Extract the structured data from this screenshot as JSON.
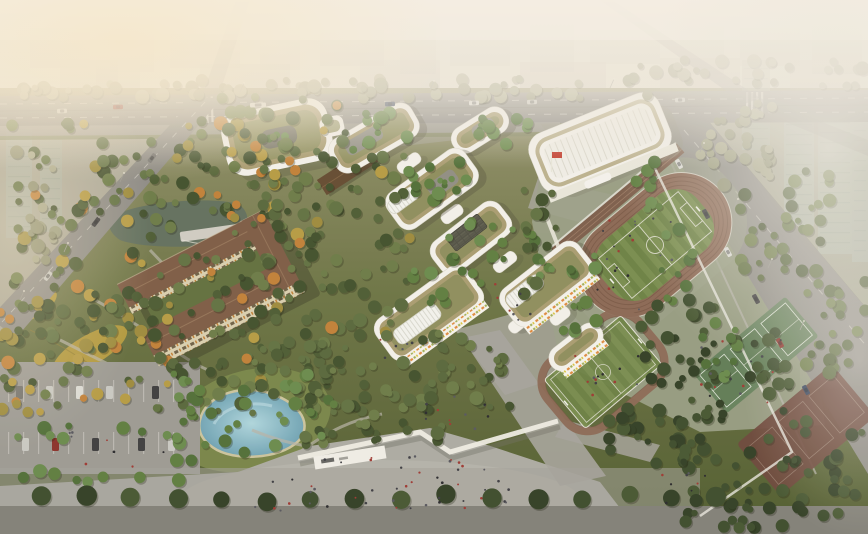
{
  "meta": {
    "type": "architectural-aerial-rendering",
    "title": "School campus aerial rendering",
    "description": "Bird's-eye architectural visualization of a school campus: white curvilinear buildings with green roofs and skylights, a gymnasium, a running track with soccer field, a training field, tennis and basketball courts, dense woodland with ponds and terraced gardens, an entrance plaza with pedestrians, a parking lot, and a hazy city skyline with roads and vehicles."
  },
  "palette": {
    "sky_top": "#d8d2c5",
    "sky_bottom": "#ece5d7",
    "fog": "#f5efe3",
    "warm_glow": "#f7e8ca",
    "city_block": "#bdb8ac",
    "city_glass": "#aeb8ab",
    "urban_ground": "#b6b2a4",
    "road": "#8d8b85",
    "road_line": "#d9d6cd",
    "campus_top": "#95926d",
    "campus_mid": "#6b7343",
    "campus_deep": "#4e5a2c",
    "apron": "#9aa087",
    "plaza": "#abaaa2",
    "pavement": "#807f77",
    "track": "#8a6753",
    "track_lane": "#70503e",
    "grandstand": "#7b5c49",
    "field_a": "#778c4c",
    "field_b": "#6a8042",
    "court_green": "#5e7b54",
    "court_base": "#62805a",
    "court_red": "#6b463a",
    "roof_olive": "#8d8d5b",
    "roof_tan": "#a89b6f",
    "building_white": "#f3f1ea",
    "skylight": "#f3f3ee",
    "panel_dark": "#4c4c40",
    "dorm_roof": "#7c5a43",
    "dorm_wall": "#d9cfae",
    "pond_blue": "#8fc0cd",
    "pond_blue_deep": "#6fa3b4",
    "pond_dark": "#5f6e5d",
    "deck": "#cfccc2",
    "terrace_yellow": "#c0a23e",
    "terrace_yellow2": "#c8ad48",
    "terrace_dark": "#a98f35",
    "path": "#b7b3a6",
    "wall_white": "#eeece4",
    "flag_red": "#c23b2c",
    "tree_forest": [
      "#3f4e2a",
      "#4a5a31",
      "#566639",
      "#5f7040",
      "#6a7a45"
    ],
    "tree_fresh": [
      "#4e6d35",
      "#5c7c3d",
      "#68894a"
    ],
    "tree_dark": [
      "#2f3d22",
      "#3a4a2a",
      "#44552f"
    ],
    "tree_hazy": [
      "#8e9071",
      "#9a9c7d",
      "#a8a88a"
    ],
    "tree_autumn": [
      "#9c8a3a",
      "#b59a41",
      "#c07f35"
    ],
    "people": [
      "#26262a",
      "#3a3a40",
      "#55555c",
      "#9c3630"
    ],
    "cars": [
      "#3b3b3d",
      "#73726e",
      "#8a2f28",
      "#dcdcd6",
      "#32405a",
      "#c9c9c2"
    ]
  },
  "scene": {
    "regions": [
      {
        "id": "city-skyline",
        "label": "Distant city blocks fading into fog"
      },
      {
        "id": "main-road",
        "label": "Arterial road along the north edge with vehicles and crosswalks"
      },
      {
        "id": "left-road",
        "label": "Diagonal street on the west side with cars"
      },
      {
        "id": "right-street",
        "label": "Tree-lined street on the east side with traffic"
      },
      {
        "id": "glass-towers",
        "label": "Tall glass residential towers in haze on the east edge"
      },
      {
        "id": "administration-building",
        "label": "Rounded green-roof courtyard building at the northwest"
      },
      {
        "id": "teaching-cluster",
        "label": "Chain of white curvilinear teaching blocks with green roofs, ribbed skylights, a solar-panel roof and tree courtyards",
        "blocks": 6
      },
      {
        "id": "gymnasium",
        "label": "White gymnasium with ribbed vaulted roof and red flag"
      },
      {
        "id": "running-track",
        "label": "Oval running track with striped soccer pitch and grandstand steps",
        "lanes": 5
      },
      {
        "id": "training-field",
        "label": "Secondary striped pitch ringed by a narrow jogging loop"
      },
      {
        "id": "green-courts",
        "label": "Row of green ball courts with white markings",
        "courts": 3
      },
      {
        "id": "red-courts",
        "label": "Red basketball courts shaded by tree rows"
      },
      {
        "id": "dormitory",
        "label": "Brown pitched-roof dormitory bars around a green courtyard",
        "wings": 2
      },
      {
        "id": "upper-pond",
        "label": "Dark reflecting pond with timber decks"
      },
      {
        "id": "lower-pond",
        "label": "Blue lagoon pond near the entrance"
      },
      {
        "id": "terraced-garden",
        "label": "Golden terraced planting beds on the southwest slope"
      },
      {
        "id": "forest",
        "label": "Dense campus woodland with autumn accents"
      },
      {
        "id": "entrance-plaza",
        "label": "Grey entrance plaza with pedestrians, white gate wall and ramps"
      },
      {
        "id": "parking-lot",
        "label": "Surface parking with marked stalls and cars"
      },
      {
        "id": "street-trees",
        "label": "Regular row of street trees along the south sidewalk"
      }
    ]
  }
}
